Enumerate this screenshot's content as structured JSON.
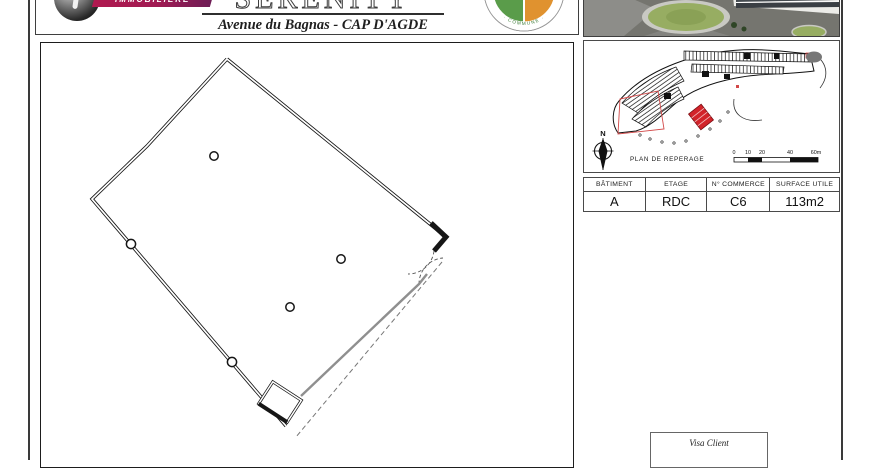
{
  "brand": {
    "ribbon_label": "IMMOBILIÈRE"
  },
  "project": {
    "title": "SERENITY",
    "address": "Avenue du Bagnas - CAP D'AGDE"
  },
  "seal": {
    "arc_text": "· COMMUNE ·"
  },
  "map": {
    "label": "PLAN DE REPERAGE",
    "compass": "N",
    "scale_ticks": [
      "0",
      "10",
      "20",
      "40",
      "60m"
    ]
  },
  "unit_table": {
    "headers": [
      "BÂTIMENT",
      "ETAGE",
      "N° COMMERCE",
      "SURFACE UTILE"
    ],
    "values": [
      "A",
      "RDC",
      "C6",
      "113m2"
    ]
  },
  "visa": {
    "label": "Visa Client"
  },
  "colors": {
    "accent_red": "#d2232a",
    "ribbon_from": "#b0194f",
    "ribbon_to": "#6e1d56",
    "seal_green": "#5a9c4a",
    "seal_orange": "#e0922f",
    "storefront_gray": "#8f8f8f"
  }
}
